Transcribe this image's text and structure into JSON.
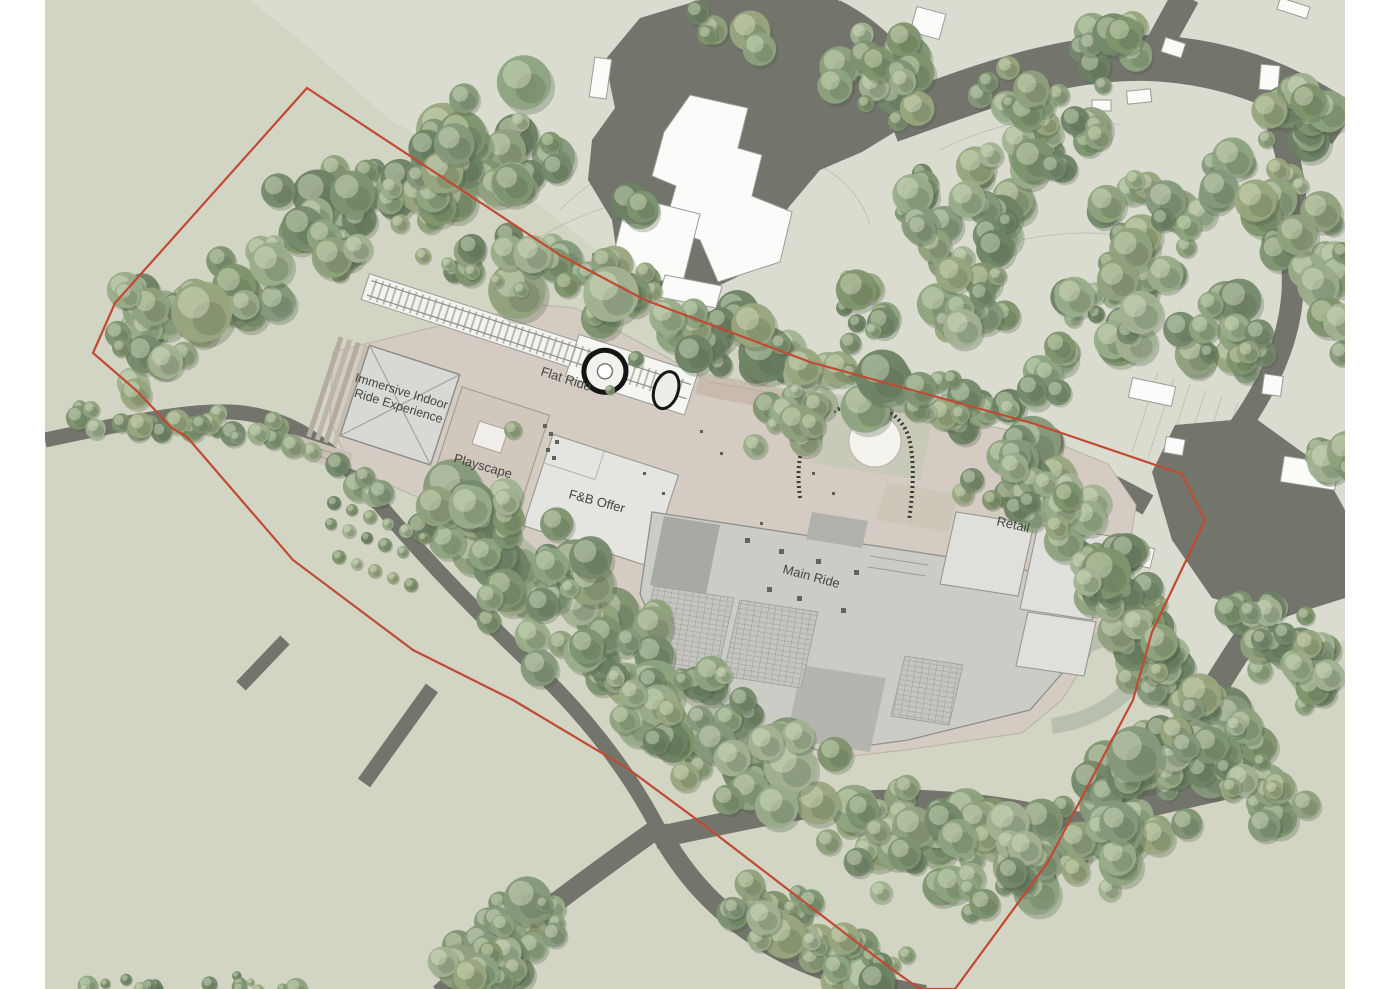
{
  "plan": {
    "labels": {
      "flat_ride": "Flat Ride",
      "immersive_line1": "Immersive Indoor",
      "immersive_line2": "Ride Experience",
      "playscape": "Playscape",
      "fnb": "F&B Offer",
      "main_ride": "Main Ride",
      "retail": "Retail"
    },
    "colors": {
      "page": "#ffffff",
      "ground": "#d2d4c4",
      "ground_upper": "#dadcd0",
      "road": "#73756d",
      "boundary_red": "#c14a33",
      "plaza": "#d4ccc2",
      "roof_light": "#d9dad6",
      "roof_mid": "#cbccc6",
      "building_white": "#fbfbfa",
      "tree_green": "#7f9371"
    }
  }
}
